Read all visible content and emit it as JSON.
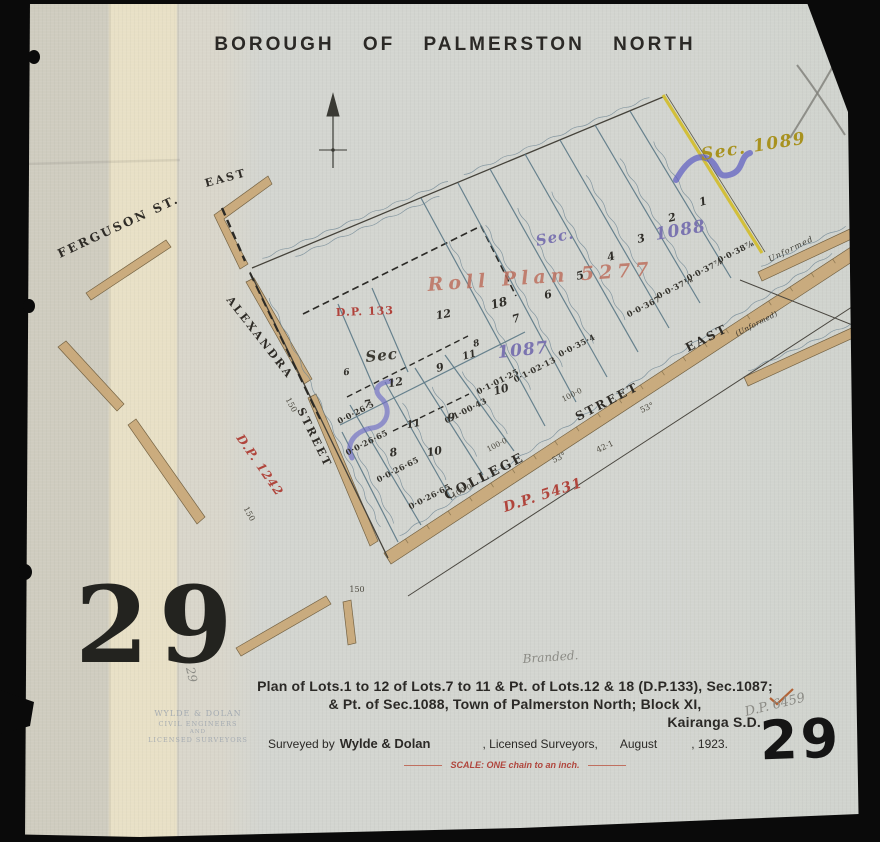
{
  "document": {
    "title": "BOROUGH OF PALMERSTON NORTH",
    "caption": {
      "line1": "Plan of Lots.1 to 12 of Lots.7 to 11 & Pt. of Lots.12 & 18 (D.P.133), Sec.1087;",
      "line2": "& Pt. of Sec.1088, Town of Palmerston North; Block XI,",
      "line3": "Kairanga S.D."
    },
    "survey_credit": {
      "prefix": "Surveyed by",
      "surveyors": "Wylde & Dolan",
      "suffix": ", Licensed Surveyors,",
      "month": "August",
      "year": ", 1923."
    },
    "scale_note": "SCALE: ONE chain to an inch.",
    "sheet_number_stencil": "29",
    "sheet_number_marker": "29"
  },
  "colors": {
    "street_fill": "#c9a878",
    "lot_line_blue": "#5b7886",
    "red_ink": "#b0453c",
    "purple_ink": "#7b74b0",
    "yellow_ink": "#a8921f",
    "yellow_edge_line": "#d2bf3a",
    "paper": "#d3d5d0",
    "backing_strip": "#e8e0c6"
  },
  "map": {
    "labels": [
      {
        "n": "label-ferguson-st",
        "t": "FERGUSON ST.",
        "x": 60,
        "y": 258,
        "r": -25,
        "c": "street",
        "s": 12
      },
      {
        "n": "label-east-upper",
        "t": "EAST",
        "x": 206,
        "y": 187,
        "r": -15,
        "c": "street",
        "s": 11
      },
      {
        "n": "label-alexandra",
        "t": "ALEXANDRA",
        "x": 226,
        "y": 300,
        "r": 52,
        "c": "street",
        "s": 11
      },
      {
        "n": "label-alexandra-street",
        "t": "STREET",
        "x": 297,
        "y": 410,
        "r": 64,
        "c": "street",
        "s": 11
      },
      {
        "n": "label-college",
        "t": "COLLEGE",
        "x": 447,
        "y": 500,
        "r": -27,
        "c": "street",
        "s": 13
      },
      {
        "n": "label-street-east-street",
        "t": "STREET",
        "x": 578,
        "y": 421,
        "r": -27,
        "c": "street",
        "s": 12
      },
      {
        "n": "label-street-east-east",
        "t": "EAST",
        "x": 688,
        "y": 352,
        "r": -27,
        "c": "street",
        "s": 12
      },
      {
        "n": "label-street-east-unformed",
        "t": "(Unformed)",
        "x": 737,
        "y": 336,
        "r": -27,
        "c": "street-sm",
        "s": 7
      },
      {
        "n": "label-unformed-band",
        "t": "Unformed",
        "x": 770,
        "y": 262,
        "r": -26,
        "c": "ink-sm",
        "s": 8
      },
      {
        "n": "label-sec-1089",
        "t": "Sec. 1089",
        "x": 702,
        "y": 160,
        "r": -9,
        "c": "sec-yellow",
        "s": 17
      },
      {
        "n": "label-sec-1088-word",
        "t": "Sec.",
        "x": 537,
        "y": 246,
        "r": -12,
        "c": "sec-purple",
        "s": 15
      },
      {
        "n": "label-sec-1088-num",
        "t": "1088",
        "x": 656,
        "y": 240,
        "r": -10,
        "c": "sec-purple",
        "s": 17
      },
      {
        "n": "label-roll-plan",
        "t": "Roll Plan 5277",
        "x": 428,
        "y": 291,
        "r": -4,
        "c": "roll-red",
        "s": 19
      },
      {
        "n": "label-dp-133",
        "t": "D.P. 133",
        "x": 336,
        "y": 316,
        "r": -2,
        "c": "red-print",
        "s": 11
      },
      {
        "n": "label-sec-1087-word",
        "t": "Sec",
        "x": 366,
        "y": 362,
        "r": -6,
        "c": "sec-ink",
        "s": 15
      },
      {
        "n": "label-sec-1087-num",
        "t": "1087",
        "x": 498,
        "y": 358,
        "r": -6,
        "c": "sec-purple",
        "s": 17
      },
      {
        "n": "label-dp-5431",
        "t": "D.P. 5431",
        "x": 505,
        "y": 512,
        "r": -18,
        "c": "red-script",
        "s": 14
      },
      {
        "n": "label-dp-1242",
        "t": "D.P. 1242",
        "x": 236,
        "y": 438,
        "r": 55,
        "c": "red-script",
        "s": 12
      },
      {
        "n": "lot-1",
        "t": "1",
        "x": 704,
        "y": 205,
        "r": -15,
        "c": "lot",
        "s": 11
      },
      {
        "n": "lot-2",
        "t": "2",
        "x": 673,
        "y": 221,
        "r": -15,
        "c": "lot",
        "s": 11
      },
      {
        "n": "lot-3",
        "t": "3",
        "x": 642,
        "y": 242,
        "r": -15,
        "c": "lot",
        "s": 11
      },
      {
        "n": "lot-4",
        "t": "4",
        "x": 612,
        "y": 260,
        "r": -15,
        "c": "lot",
        "s": 11
      },
      {
        "n": "lot-5",
        "t": "5",
        "x": 581,
        "y": 279,
        "r": -15,
        "c": "lot",
        "s": 11
      },
      {
        "n": "lot-6",
        "t": "6",
        "x": 549,
        "y": 298,
        "r": -15,
        "c": "lot",
        "s": 11
      },
      {
        "n": "lot-18",
        "t": "18",
        "x": 500,
        "y": 307,
        "r": -15,
        "c": "lot",
        "s": 12
      },
      {
        "n": "lot-7",
        "t": "7",
        "x": 517,
        "y": 322,
        "r": -15,
        "c": "lot",
        "s": 11
      },
      {
        "n": "lot-12",
        "t": "12",
        "x": 444,
        "y": 318,
        "r": -10,
        "c": "lot",
        "s": 11
      },
      {
        "n": "lot-8",
        "t": "8",
        "x": 477,
        "y": 346,
        "r": -15,
        "c": "lot",
        "s": 9
      },
      {
        "n": "lot-11",
        "t": "11",
        "x": 470,
        "y": 358,
        "r": -15,
        "c": "lot",
        "s": 10
      },
      {
        "n": "lot-9",
        "t": "9",
        "x": 441,
        "y": 371,
        "r": -15,
        "c": "lot",
        "s": 11
      },
      {
        "n": "lot-10",
        "t": "10",
        "x": 502,
        "y": 393,
        "r": -15,
        "c": "lot",
        "s": 11
      },
      {
        "n": "lot-12b",
        "t": "12",
        "x": 396,
        "y": 386,
        "r": -10,
        "c": "lot",
        "s": 11
      },
      {
        "n": "lot-7b",
        "t": "7",
        "x": 368,
        "y": 407,
        "r": -10,
        "c": "lot",
        "s": 10
      },
      {
        "n": "lot-11b",
        "t": "11",
        "x": 414,
        "y": 427,
        "r": -10,
        "c": "lot",
        "s": 10
      },
      {
        "n": "lot-9b",
        "t": "9",
        "x": 452,
        "y": 421,
        "r": -10,
        "c": "lot",
        "s": 11
      },
      {
        "n": "lot-10b",
        "t": "10",
        "x": 435,
        "y": 455,
        "r": -10,
        "c": "lot",
        "s": 11
      },
      {
        "n": "lot-8b",
        "t": "8",
        "x": 394,
        "y": 456,
        "r": -10,
        "c": "lot",
        "s": 11
      },
      {
        "n": "lot-6b",
        "t": "6",
        "x": 347,
        "y": 375,
        "r": -10,
        "c": "lot",
        "s": 9
      },
      {
        "n": "area-lot1",
        "t": "0·0·38⅞",
        "x": 737,
        "y": 254,
        "r": -27,
        "c": "area",
        "s": 8
      },
      {
        "n": "area-lot2",
        "t": "0·0·37⅞",
        "x": 706,
        "y": 272,
        "r": -27,
        "c": "area",
        "s": 8
      },
      {
        "n": "area-lot3",
        "t": "0·0·37⅛",
        "x": 676,
        "y": 290,
        "r": -27,
        "c": "area",
        "s": 8
      },
      {
        "n": "area-lot4",
        "t": "0·0·367",
        "x": 645,
        "y": 309,
        "r": -27,
        "c": "area",
        "s": 8
      },
      {
        "n": "area-lot5",
        "t": "0·0·35·4",
        "x": 578,
        "y": 348,
        "r": -27,
        "c": "area",
        "s": 8
      },
      {
        "n": "area-lot7",
        "t": "0·1·02·13",
        "x": 536,
        "y": 372,
        "r": -27,
        "c": "area",
        "s": 8
      },
      {
        "n": "area-lot8",
        "t": "0·1·01·25",
        "x": 499,
        "y": 384,
        "r": -27,
        "c": "area",
        "s": 8
      },
      {
        "n": "area-lot10",
        "t": "0·1·00·43",
        "x": 467,
        "y": 413,
        "r": -27,
        "c": "area",
        "s": 8
      },
      {
        "n": "area-lot12b",
        "t": "0·0·26·5",
        "x": 357,
        "y": 415,
        "r": -27,
        "c": "area",
        "s": 8
      },
      {
        "n": "area-a",
        "t": "0·0·26·65",
        "x": 368,
        "y": 445,
        "r": -27,
        "c": "area",
        "s": 8
      },
      {
        "n": "area-b",
        "t": "0·0·26·65",
        "x": 399,
        "y": 472,
        "r": -27,
        "c": "area",
        "s": 8
      },
      {
        "n": "area-c",
        "t": "0·0·26·65",
        "x": 431,
        "y": 499,
        "r": -27,
        "c": "area",
        "s": 8
      },
      {
        "n": "dim-150-a",
        "t": "150",
        "x": 289,
        "y": 406,
        "r": 62,
        "c": "dim",
        "s": 8
      },
      {
        "n": "dim-150-b",
        "t": "150",
        "x": 247,
        "y": 515,
        "r": 62,
        "c": "dim",
        "s": 8
      },
      {
        "n": "dim-150-c",
        "t": "150",
        "x": 357,
        "y": 592,
        "r": 0,
        "c": "dim",
        "s": 8
      },
      {
        "n": "dim-53-a",
        "t": "53°",
        "x": 560,
        "y": 460,
        "r": -25,
        "c": "dim",
        "s": 8
      },
      {
        "n": "dim-42-1",
        "t": "42·1",
        "x": 606,
        "y": 449,
        "r": -25,
        "c": "dim",
        "s": 8
      },
      {
        "n": "dim-53-b",
        "t": "53°",
        "x": 648,
        "y": 410,
        "r": -25,
        "c": "dim",
        "s": 8
      },
      {
        "n": "dim-100-a",
        "t": "100·0",
        "x": 498,
        "y": 447,
        "r": -27,
        "c": "dim",
        "s": 7.5
      },
      {
        "n": "dim-100-b",
        "t": "100·0",
        "x": 573,
        "y": 397,
        "r": -27,
        "c": "dim",
        "s": 7.5
      },
      {
        "n": "dim-100-c",
        "t": "100·0",
        "x": 463,
        "y": 493,
        "r": -27,
        "c": "dim",
        "s": 7.5
      },
      {
        "n": "pencil-branded",
        "t": "Branded.",
        "x": 523,
        "y": 663,
        "r": -4,
        "c": "pencil",
        "s": 12
      },
      {
        "n": "pencil-dp-6459",
        "t": "D.P. 6459",
        "x": 746,
        "y": 716,
        "r": -14,
        "c": "pencil",
        "s": 13
      },
      {
        "n": "pencil-29",
        "t": "29",
        "x": 186,
        "y": 668,
        "r": 78,
        "c": "pencil",
        "s": 12
      },
      {
        "n": "stamp-line1",
        "t": "WYLDE & DOLAN",
        "x": 198,
        "y": 716,
        "r": 0,
        "c": "stamp",
        "s": 8
      },
      {
        "n": "stamp-line2",
        "t": "CIVIL ENGINEERS",
        "x": 198,
        "y": 726,
        "r": 0,
        "c": "stamp",
        "s": 6.5
      },
      {
        "n": "stamp-line3",
        "t": "AND",
        "x": 198,
        "y": 733,
        "r": 0,
        "c": "stamp",
        "s": 5.5
      },
      {
        "n": "stamp-line4",
        "t": "LICENSED SURVEYORS",
        "x": 198,
        "y": 742,
        "r": 0,
        "c": "stamp",
        "s": 6.5
      }
    ]
  }
}
